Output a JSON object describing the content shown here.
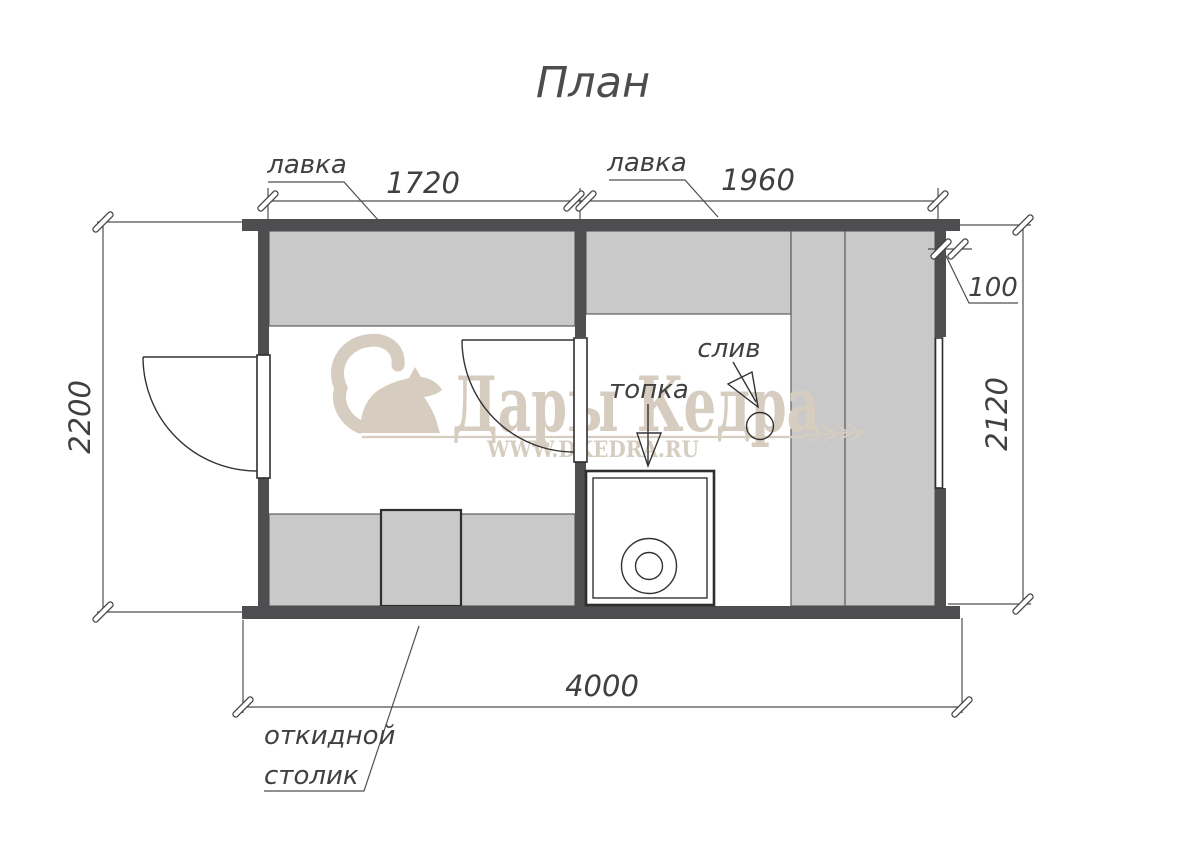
{
  "title": "План",
  "labels": {
    "bench": "лавка",
    "stove": "топка",
    "drain": "слив",
    "table_line1": "откидной",
    "table_line2": "столик"
  },
  "dims": {
    "width_left": "1720",
    "width_right": "1960",
    "wall": "100",
    "height_left": "2200",
    "height_right": "2120",
    "total": "4000"
  },
  "watermark": {
    "brand": "Дары Кедра",
    "url": "WWW.DKEDRA.RU"
  },
  "colors": {
    "wall": "#4e4e50",
    "bench": "#c9c9c9",
    "line": "#4a4a4a",
    "ink": "#2e2e2e",
    "watermark": "#d6cdc0",
    "background": "#ffffff"
  }
}
